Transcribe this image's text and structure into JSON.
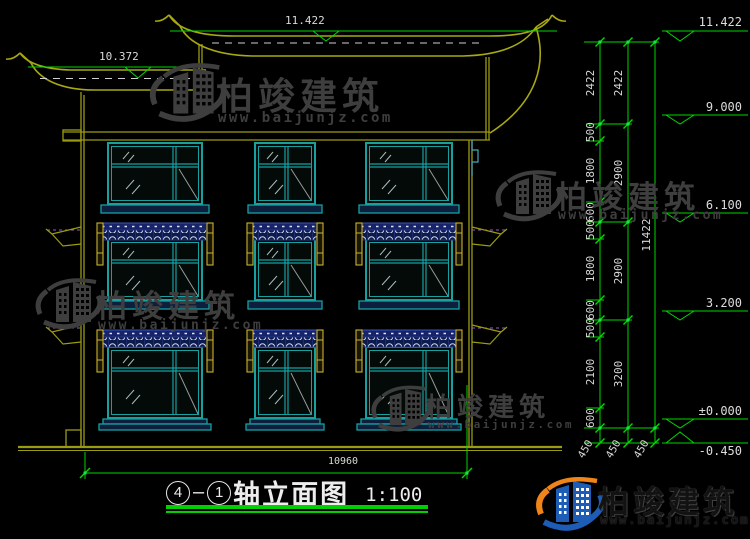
{
  "title": {
    "axis_start": "4",
    "axis_dash": "–",
    "axis_end": "1",
    "name": "轴立面图",
    "scale": "1:100"
  },
  "watermark": {
    "brand": "柏竣建筑",
    "url": "www.baijunjz.com"
  },
  "dimensions": {
    "roof_main_level": "11.422",
    "roof_left_level": "10.372",
    "total_width": "10960",
    "total_height": "11422",
    "right_col_inner": [
      "2422",
      "500",
      "1800",
      "600",
      "500",
      "1800",
      "600",
      "500",
      "2100",
      "600"
    ],
    "right_col_mid": [
      "2422",
      "2900",
      "2900",
      "3200"
    ],
    "base_offsets": [
      "450",
      "450",
      "450"
    ],
    "levels": [
      "11.422",
      "9.000",
      "6.100",
      "3.200",
      "±0.000",
      "-0.450"
    ]
  },
  "colors": {
    "dimension_green": "#00d800",
    "structure_olive": "#9b9b12",
    "window_teal": "#16a0a0",
    "canopy_navy": "#17246b",
    "watermark_grey": "#3e3e3e",
    "logo_blue": "#1d5db5",
    "logo_orange": "#f08418"
  }
}
